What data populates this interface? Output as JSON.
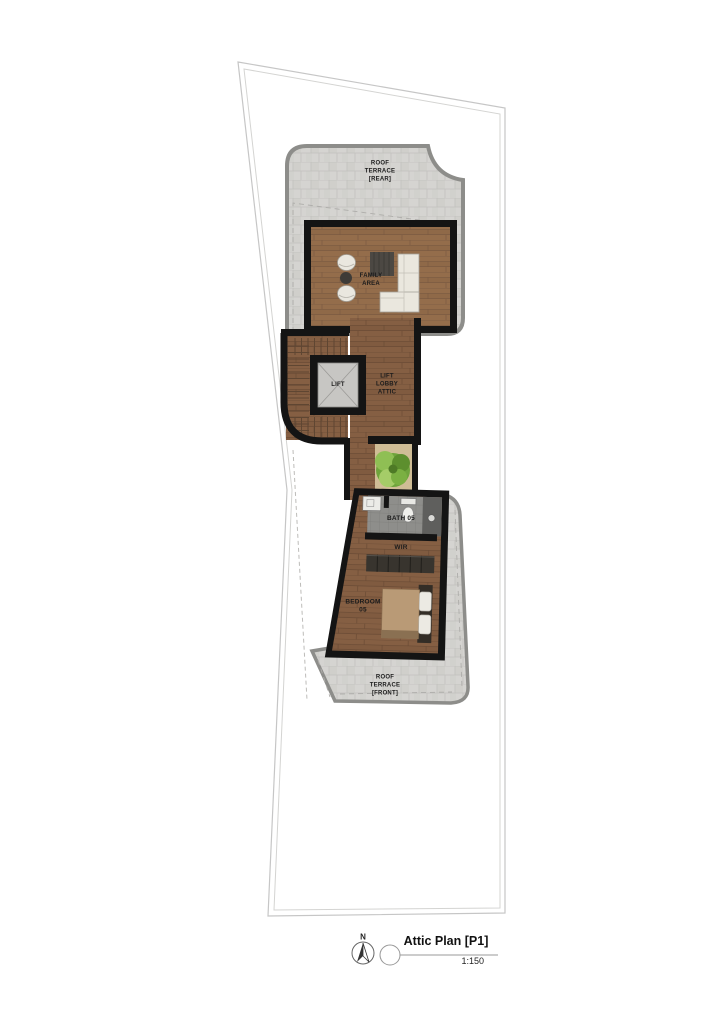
{
  "plan": {
    "areas": {
      "roof_terrace_rear": "ROOF\nTERRACE\n[REAR]",
      "family_area": "FAMILY\nAREA",
      "lift": "LIFT",
      "lift_lobby": "LIFT\nLOBBY\nATTIC",
      "bath": "BATH 05",
      "wir": "WIR",
      "bedroom": "BEDROOM\n05",
      "roof_terrace_front": "ROOF\nTERRACE\n[FRONT]"
    },
    "title_block": {
      "north_label": "N",
      "title": "Attic Plan [P1]",
      "scale": "1:150"
    },
    "colors": {
      "wall": "#141414",
      "wood_floor": "#946d4b",
      "wood_floor_dark": "#855f43",
      "stone_paving": "#d5d4d1",
      "terrace_border": "#8d8d8a",
      "bath_tile": "#8e8e8b",
      "plant_green": "#6fa43c",
      "planter_ground": "#cfbd96",
      "boundary_line": "#c6c6c6"
    }
  }
}
